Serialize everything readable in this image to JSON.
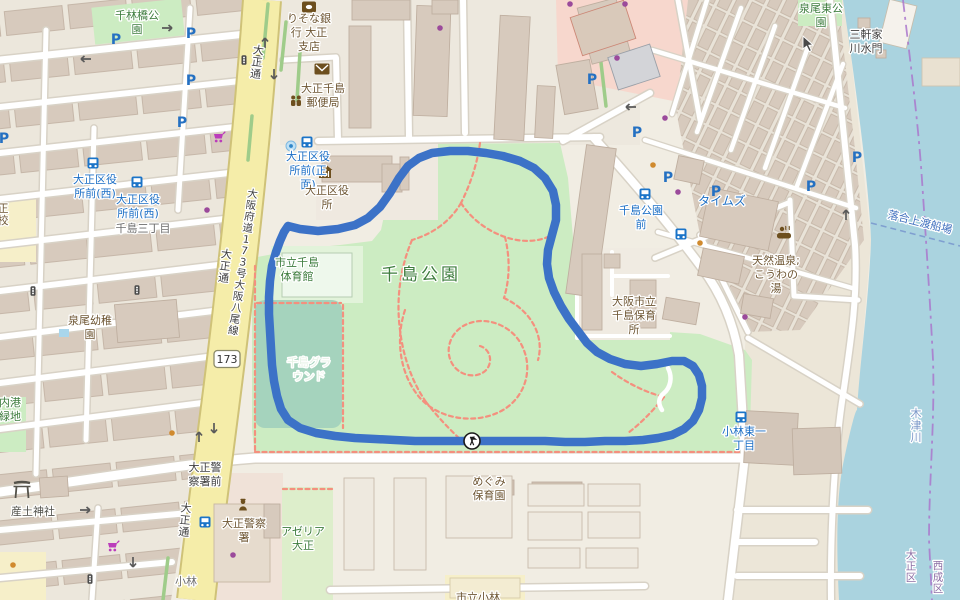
{
  "map": {
    "title": "OpenStreetMap view of Chishima Park area, Taisho-ku Osaka, with GPS track",
    "colors": {
      "route": "#3c72c7",
      "water": "#aad3df",
      "park": "#ccecc2",
      "pitch": "#a5d3bd",
      "road_major": "#f5eda9",
      "road_major_casing": "#cfc278",
      "building": "#d7cabd",
      "retail": "#f7d7cd",
      "school": "#f6efc9",
      "boundary": "#aa77cc",
      "bus_label": "#1b6ec5",
      "poi_label": "#6e5633",
      "park_label": "#3d7c3d",
      "footpath": "#f4907e"
    },
    "route": {
      "width": 8.5,
      "points": [
        [
          288,
          226
        ],
        [
          300,
          229
        ],
        [
          318,
          231
        ],
        [
          338,
          229
        ],
        [
          355,
          225
        ],
        [
          368,
          218
        ],
        [
          380,
          207
        ],
        [
          390,
          193
        ],
        [
          399,
          178
        ],
        [
          408,
          166
        ],
        [
          419,
          158
        ],
        [
          432,
          153
        ],
        [
          450,
          151
        ],
        [
          468,
          151
        ],
        [
          486,
          153
        ],
        [
          503,
          156
        ],
        [
          520,
          161
        ],
        [
          534,
          168
        ],
        [
          545,
          178
        ],
        [
          553,
          191
        ],
        [
          556,
          205
        ],
        [
          556,
          220
        ],
        [
          552,
          235
        ],
        [
          548,
          250
        ],
        [
          547,
          264
        ],
        [
          549,
          278
        ],
        [
          554,
          292
        ],
        [
          561,
          306
        ],
        [
          569,
          319
        ],
        [
          578,
          331
        ],
        [
          587,
          343
        ],
        [
          597,
          352
        ],
        [
          610,
          359
        ],
        [
          625,
          364
        ],
        [
          641,
          366
        ],
        [
          657,
          364
        ],
        [
          672,
          361
        ],
        [
          684,
          361
        ],
        [
          693,
          366
        ],
        [
          699,
          375
        ],
        [
          702,
          386
        ],
        [
          702,
          398
        ],
        [
          699,
          410
        ],
        [
          693,
          421
        ],
        [
          684,
          429
        ],
        [
          672,
          435
        ],
        [
          658,
          438
        ],
        [
          643,
          440
        ],
        [
          625,
          441
        ],
        [
          605,
          441
        ],
        [
          585,
          442
        ],
        [
          565,
          442
        ],
        [
          545,
          441
        ],
        [
          525,
          441
        ],
        [
          505,
          441
        ],
        [
          485,
          441
        ],
        [
          472,
          441
        ],
        [
          455,
          441
        ],
        [
          435,
          441
        ],
        [
          415,
          441
        ],
        [
          395,
          440
        ],
        [
          375,
          439
        ],
        [
          355,
          438
        ],
        [
          335,
          436
        ],
        [
          316,
          433
        ],
        [
          300,
          428
        ],
        [
          288,
          420
        ],
        [
          281,
          409
        ],
        [
          277,
          396
        ],
        [
          274,
          381
        ],
        [
          272,
          365
        ],
        [
          271,
          348
        ],
        [
          270,
          331
        ],
        [
          269,
          314
        ],
        [
          269,
          297
        ],
        [
          270,
          281
        ],
        [
          272,
          266
        ],
        [
          276,
          252
        ],
        [
          280,
          241
        ],
        [
          284,
          232
        ],
        [
          288,
          226
        ]
      ],
      "marker": {
        "x": 472,
        "y": 441,
        "kind": "start-finish-flags"
      }
    },
    "shield": {
      "text": "173",
      "x": 227,
      "y": 359
    },
    "labels": [
      {
        "cls": "park",
        "x": 137,
        "y": 22,
        "lines": [
          "千林橋公",
          "園"
        ]
      },
      {
        "cls": "poi",
        "x": 309,
        "y": 32,
        "lines": [
          "りそな銀",
          "行 大正",
          "支店"
        ]
      },
      {
        "cls": "poi",
        "x": 323,
        "y": 95,
        "lines": [
          "大正千島",
          "郵便局"
        ]
      },
      {
        "cls": "bus",
        "x": 95,
        "y": 186,
        "lines": [
          "大正区役",
          "所前(西)"
        ]
      },
      {
        "cls": "bus",
        "x": 138,
        "y": 206,
        "lines": [
          "大正区役",
          "所前(西)"
        ]
      },
      {
        "cls": "place",
        "x": 143,
        "y": 228,
        "lines": [
          "千島三丁目"
        ]
      },
      {
        "cls": "bus",
        "x": 308,
        "y": 170,
        "lines": [
          "大正区役",
          "所前(正",
          "面)"
        ]
      },
      {
        "cls": "poi",
        "x": 327,
        "y": 197,
        "lines": [
          "大正区役",
          "所"
        ]
      },
      {
        "cls": "park",
        "x": 297,
        "y": 269,
        "lines": [
          "市立千島",
          "体育館"
        ]
      },
      {
        "cls": "park-big",
        "x": 421,
        "y": 274,
        "lines": [
          "千島公園"
        ],
        "size": 17
      },
      {
        "cls": "pitch",
        "x": 309,
        "y": 369,
        "lines": [
          "千島グラ",
          "ウンド"
        ]
      },
      {
        "cls": "poi",
        "x": 90,
        "y": 327,
        "lines": [
          "泉尾幼稚",
          "園"
        ]
      },
      {
        "cls": "park",
        "x": 821,
        "y": 15,
        "lines": [
          "泉尾東公",
          "園"
        ]
      },
      {
        "cls": "dark",
        "x": 866,
        "y": 41,
        "lines": [
          "三軒家",
          "川水門"
        ]
      },
      {
        "cls": "water",
        "x": 916,
        "y": 425,
        "lines": [
          "木津川"
        ],
        "vertical": true
      },
      {
        "cls": "water2",
        "x": 920,
        "y": 222,
        "lines": [
          "落合上渡船場"
        ],
        "rot": 14
      },
      {
        "cls": "bus",
        "x": 641,
        "y": 217,
        "lines": [
          "千島公園",
          "前"
        ]
      },
      {
        "cls": "bus",
        "x": 722,
        "y": 201,
        "lines": [
          "タイムズ"
        ],
        "size": 12
      },
      {
        "cls": "poi",
        "x": 776,
        "y": 274,
        "lines": [
          "天然温泉;",
          "こうわの",
          "湯"
        ]
      },
      {
        "cls": "poi",
        "x": 634,
        "y": 315,
        "lines": [
          "大阪市立",
          "千島保育",
          "所"
        ]
      },
      {
        "cls": "bus",
        "x": 744,
        "y": 438,
        "lines": [
          "小林東一",
          "丁目"
        ]
      },
      {
        "cls": "dark",
        "x": 205,
        "y": 474,
        "lines": [
          "大正警",
          "察署前"
        ]
      },
      {
        "cls": "poi",
        "x": 244,
        "y": 530,
        "lines": [
          "大正警察",
          "署"
        ]
      },
      {
        "cls": "park",
        "x": 303,
        "y": 538,
        "lines": [
          "アゼリア",
          "大正"
        ]
      },
      {
        "cls": "poi",
        "x": 489,
        "y": 488,
        "lines": [
          "めぐみ",
          "保育園"
        ]
      },
      {
        "cls": "poi",
        "x": 478,
        "y": 597,
        "lines": [
          "市立小林"
        ]
      },
      {
        "cls": "shrine",
        "x": 33,
        "y": 511,
        "lines": [
          "産土神社"
        ]
      },
      {
        "cls": "place",
        "x": 186,
        "y": 581,
        "lines": [
          "小林"
        ]
      },
      {
        "cls": "park",
        "x": 10,
        "y": 409,
        "lines": [
          "内港",
          "緑地"
        ]
      },
      {
        "cls": "ward",
        "x": 938,
        "y": 577,
        "lines": [
          "西成区"
        ],
        "vertical": true,
        "size": 10.5
      },
      {
        "cls": "ward",
        "x": 911,
        "y": 566,
        "lines": [
          "大正区"
        ],
        "vertical": true,
        "size": 10.5
      },
      {
        "cls": "road",
        "x": 257,
        "y": 62,
        "lines": [
          "大正通"
        ],
        "vertical": true,
        "rot": 7
      },
      {
        "cls": "road",
        "x": 225,
        "y": 266,
        "lines": [
          "大正通"
        ],
        "vertical": true,
        "rot": 7
      },
      {
        "cls": "road",
        "x": 185,
        "y": 520,
        "lines": [
          "大正通"
        ],
        "vertical": true,
        "rot": 5
      },
      {
        "cls": "road",
        "x": 243,
        "y": 262,
        "lines": [
          "大阪府道173号大阪八尾線"
        ],
        "vertical": true,
        "rot": 8,
        "size": 10.5
      },
      {
        "cls": "poi",
        "x": 3,
        "y": 214,
        "lines": [
          "正校"
        ],
        "vertical": true
      }
    ],
    "icons": [
      {
        "t": "parking",
        "x": 116,
        "y": 39
      },
      {
        "t": "parking",
        "x": 191,
        "y": 33
      },
      {
        "t": "parking",
        "x": 191,
        "y": 80
      },
      {
        "t": "parking",
        "x": 182,
        "y": 122
      },
      {
        "t": "parking",
        "x": 4,
        "y": 138
      },
      {
        "t": "parking",
        "x": 592,
        "y": 79
      },
      {
        "t": "parking",
        "x": 668,
        "y": 177
      },
      {
        "t": "parking",
        "x": 716,
        "y": 191
      },
      {
        "t": "parking",
        "x": 857,
        "y": 157
      },
      {
        "t": "parking",
        "x": 811,
        "y": 186
      },
      {
        "t": "parking",
        "x": 637,
        "y": 132
      },
      {
        "t": "bus-stop",
        "x": 93,
        "y": 163
      },
      {
        "t": "bus-stop",
        "x": 137,
        "y": 182
      },
      {
        "t": "bus-stop",
        "x": 307,
        "y": 142
      },
      {
        "t": "bus-stop",
        "x": 645,
        "y": 194
      },
      {
        "t": "bus-stop",
        "x": 681,
        "y": 234
      },
      {
        "t": "bus-stop",
        "x": 205,
        "y": 522
      },
      {
        "t": "bus-stop",
        "x": 741,
        "y": 417
      },
      {
        "t": "bank",
        "x": 309,
        "y": 7
      },
      {
        "t": "post-office",
        "x": 322,
        "y": 69
      },
      {
        "t": "community-centre",
        "x": 296,
        "y": 101
      },
      {
        "t": "town-hall",
        "x": 325,
        "y": 172
      },
      {
        "t": "onsen",
        "x": 784,
        "y": 233
      },
      {
        "t": "police",
        "x": 243,
        "y": 506
      },
      {
        "t": "torii",
        "x": 22,
        "y": 490
      },
      {
        "t": "supermarket-cart",
        "x": 219,
        "y": 138
      },
      {
        "t": "supermarket-cart",
        "x": 113,
        "y": 547
      },
      {
        "t": "bicycle-parking",
        "x": 291,
        "y": 146
      },
      {
        "t": "pool",
        "x": 64,
        "y": 333
      },
      {
        "t": "traffic-signal",
        "x": 244,
        "y": 60
      },
      {
        "t": "traffic-signal",
        "x": 258,
        "y": 60
      },
      {
        "t": "traffic-signal",
        "x": 33,
        "y": 291
      },
      {
        "t": "traffic-signal",
        "x": 137,
        "y": 290
      },
      {
        "t": "traffic-signal",
        "x": 90,
        "y": 579
      },
      {
        "t": "arrow-right",
        "x": 168,
        "y": 28
      },
      {
        "t": "arrow-left",
        "x": 85,
        "y": 59
      },
      {
        "t": "arrow-up",
        "x": 265,
        "y": 42
      },
      {
        "t": "arrow-down",
        "x": 274,
        "y": 75
      },
      {
        "t": "arrow-up",
        "x": 199,
        "y": 436
      },
      {
        "t": "arrow-down",
        "x": 214,
        "y": 429
      },
      {
        "t": "arrow-up",
        "x": 846,
        "y": 214
      },
      {
        "t": "arrow-left",
        "x": 630,
        "y": 107
      },
      {
        "t": "arrow-down",
        "x": 133,
        "y": 563
      },
      {
        "t": "arrow-right",
        "x": 86,
        "y": 510
      },
      {
        "t": "shop-dot",
        "x": 440,
        "y": 28
      },
      {
        "t": "shop-dot",
        "x": 570,
        "y": 4
      },
      {
        "t": "shop-dot",
        "x": 625,
        "y": 4
      },
      {
        "t": "shop-dot",
        "x": 617,
        "y": 58
      },
      {
        "t": "shop-dot",
        "x": 207,
        "y": 210
      },
      {
        "t": "shop-dot",
        "x": 665,
        "y": 118
      },
      {
        "t": "shop-dot",
        "x": 678,
        "y": 192
      },
      {
        "t": "shop-dot",
        "x": 745,
        "y": 317
      },
      {
        "t": "shop-dot",
        "x": 233,
        "y": 555
      },
      {
        "t": "food-dot",
        "x": 653,
        "y": 165
      },
      {
        "t": "food-dot",
        "x": 700,
        "y": 243
      },
      {
        "t": "food-dot",
        "x": 172,
        "y": 433
      },
      {
        "t": "food-dot",
        "x": 13,
        "y": 565
      },
      {
        "t": "mouse-cursor",
        "x": 803,
        "y": 36
      }
    ]
  }
}
